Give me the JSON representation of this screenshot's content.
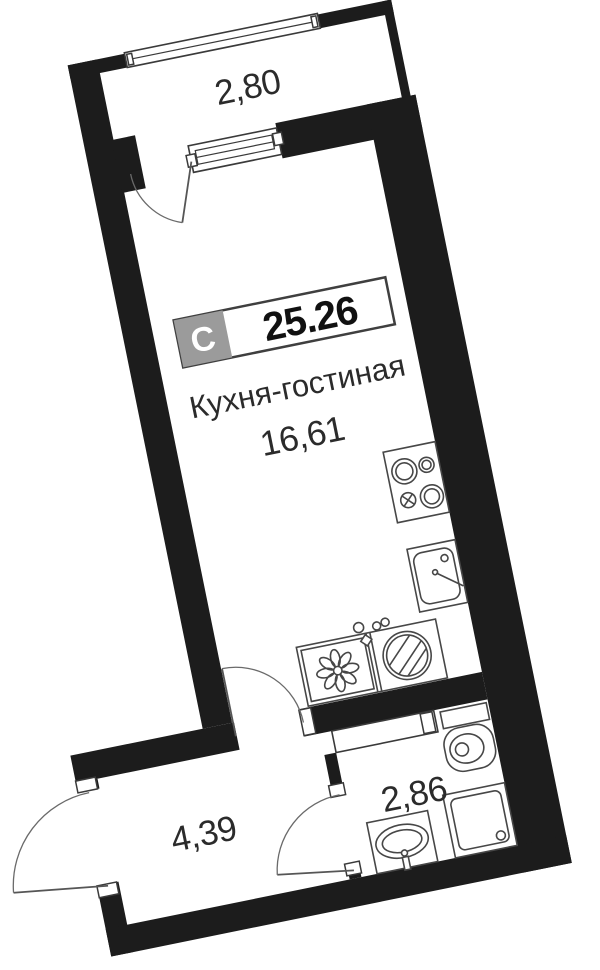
{
  "plan": {
    "badge": {
      "type_label": "С",
      "total_area": "25.26"
    },
    "rooms": [
      {
        "id": "balcony",
        "area": "2,80"
      },
      {
        "id": "kitchen-living",
        "name": "Кухня-гостиная",
        "area": "16,61"
      },
      {
        "id": "hallway",
        "area": "4,39"
      },
      {
        "id": "bathroom",
        "area": "2,86"
      }
    ],
    "colors": {
      "wall": "#1c1c1c",
      "fixture_line": "#474747",
      "badge_gray": "#9b9b9b",
      "badge_border": "#3f3f3f",
      "text": "#2b2b2b",
      "background": "#ffffff"
    },
    "fixtures": [
      "balcony-window",
      "balcony-door",
      "cooktop",
      "kitchen-sink",
      "kitchen-counter",
      "washing-machine",
      "vent-shaft",
      "toilet",
      "shower-cabin",
      "washbasin",
      "entry-door",
      "kitchen-hall-door",
      "bathroom-door"
    ]
  }
}
